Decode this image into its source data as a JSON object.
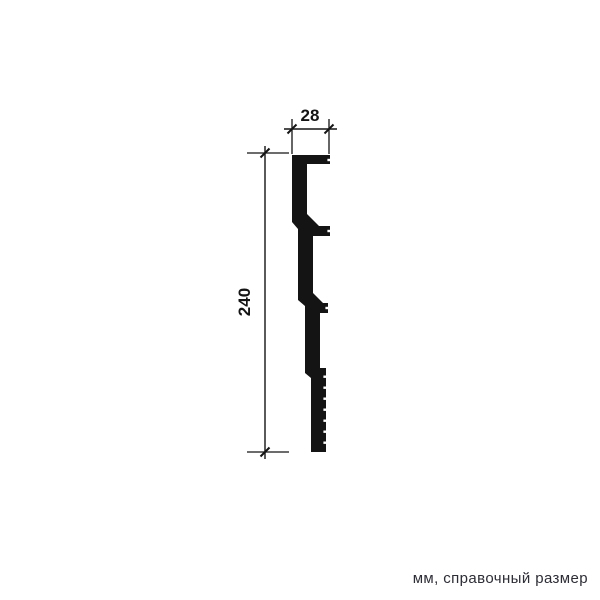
{
  "figure": {
    "kind": "molding-profile-technical-drawing",
    "note": "мм, справочный размер",
    "colors": {
      "ink": "#141414",
      "background": "#ffffff",
      "note_text": "#2d2d36"
    },
    "dimensions": [
      {
        "id": "width",
        "value": "28",
        "orientation": "horizontal"
      },
      {
        "id": "height",
        "value": "240",
        "orientation": "vertical"
      }
    ],
    "profile": {
      "points": [
        [
          292,
          155
        ],
        [
          330,
          155
        ],
        [
          330,
          164
        ],
        [
          307,
          164
        ],
        [
          307,
          214
        ],
        [
          319,
          226
        ],
        [
          330,
          226
        ],
        [
          330,
          236
        ],
        [
          313,
          236
        ],
        [
          313,
          293
        ],
        [
          323,
          303
        ],
        [
          328,
          303
        ],
        [
          328,
          313
        ],
        [
          320,
          313
        ],
        [
          320,
          368
        ],
        [
          326,
          368
        ],
        [
          326,
          452
        ],
        [
          311,
          452
        ],
        [
          311,
          378
        ],
        [
          305,
          373
        ],
        [
          305,
          306
        ],
        [
          298,
          300
        ],
        [
          298,
          229
        ],
        [
          292,
          222
        ]
      ],
      "serrations": {
        "x": 326,
        "ys": [
          375.5,
          386.5,
          397.5,
          408.5,
          419.5,
          430.5,
          441.5
        ]
      },
      "edge_dashes": [
        [
          330,
          160
        ],
        [
          330,
          231
        ],
        [
          328,
          308
        ]
      ]
    },
    "dims_geometry": {
      "width": {
        "ext": [
          [
            292,
            119,
            292,
            154
          ],
          [
            329,
            119,
            329,
            154
          ]
        ],
        "line": [
          284,
          129,
          337,
          129
        ],
        "ticks": [
          [
            292,
            129
          ],
          [
            329,
            129
          ]
        ],
        "label_pos": [
          310,
          121
        ]
      },
      "height": {
        "ext": [
          [
            247,
            153,
            289,
            153
          ],
          [
            247,
            452,
            289,
            452
          ]
        ],
        "line": [
          265,
          146,
          265,
          459
        ],
        "ticks": [
          [
            265,
            153
          ],
          [
            265,
            452
          ]
        ],
        "label_pos": [
          250,
          302
        ],
        "label_rotation": -90
      }
    }
  }
}
